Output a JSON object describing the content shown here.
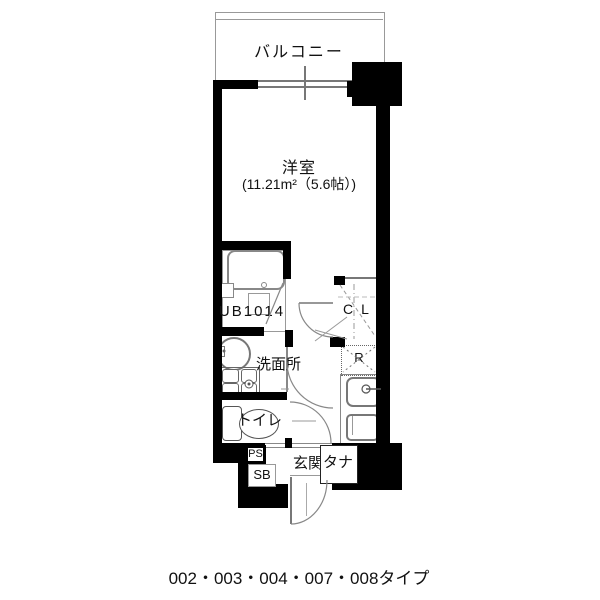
{
  "floor_plan": {
    "balcony": {
      "label": "バルコニー"
    },
    "main_room": {
      "label": "洋室",
      "area": "(11.21m²（5.6帖）)"
    },
    "bath": {
      "label": "UB1014"
    },
    "washroom": {
      "label": "洗面所"
    },
    "toilet": {
      "label": "トイレ"
    },
    "closet": {
      "label": "CL"
    },
    "refrigerator_space": {
      "label": "R"
    },
    "pipe_space": {
      "label": "PS"
    },
    "shoe_box": {
      "label": "SB"
    },
    "entrance": {
      "label": "玄関",
      "shelf_label": "タナ"
    },
    "caption": "002・003・004・007・008タイプ",
    "colors": {
      "wall": "#000000",
      "line": "#808080",
      "background": "#ffffff"
    }
  }
}
